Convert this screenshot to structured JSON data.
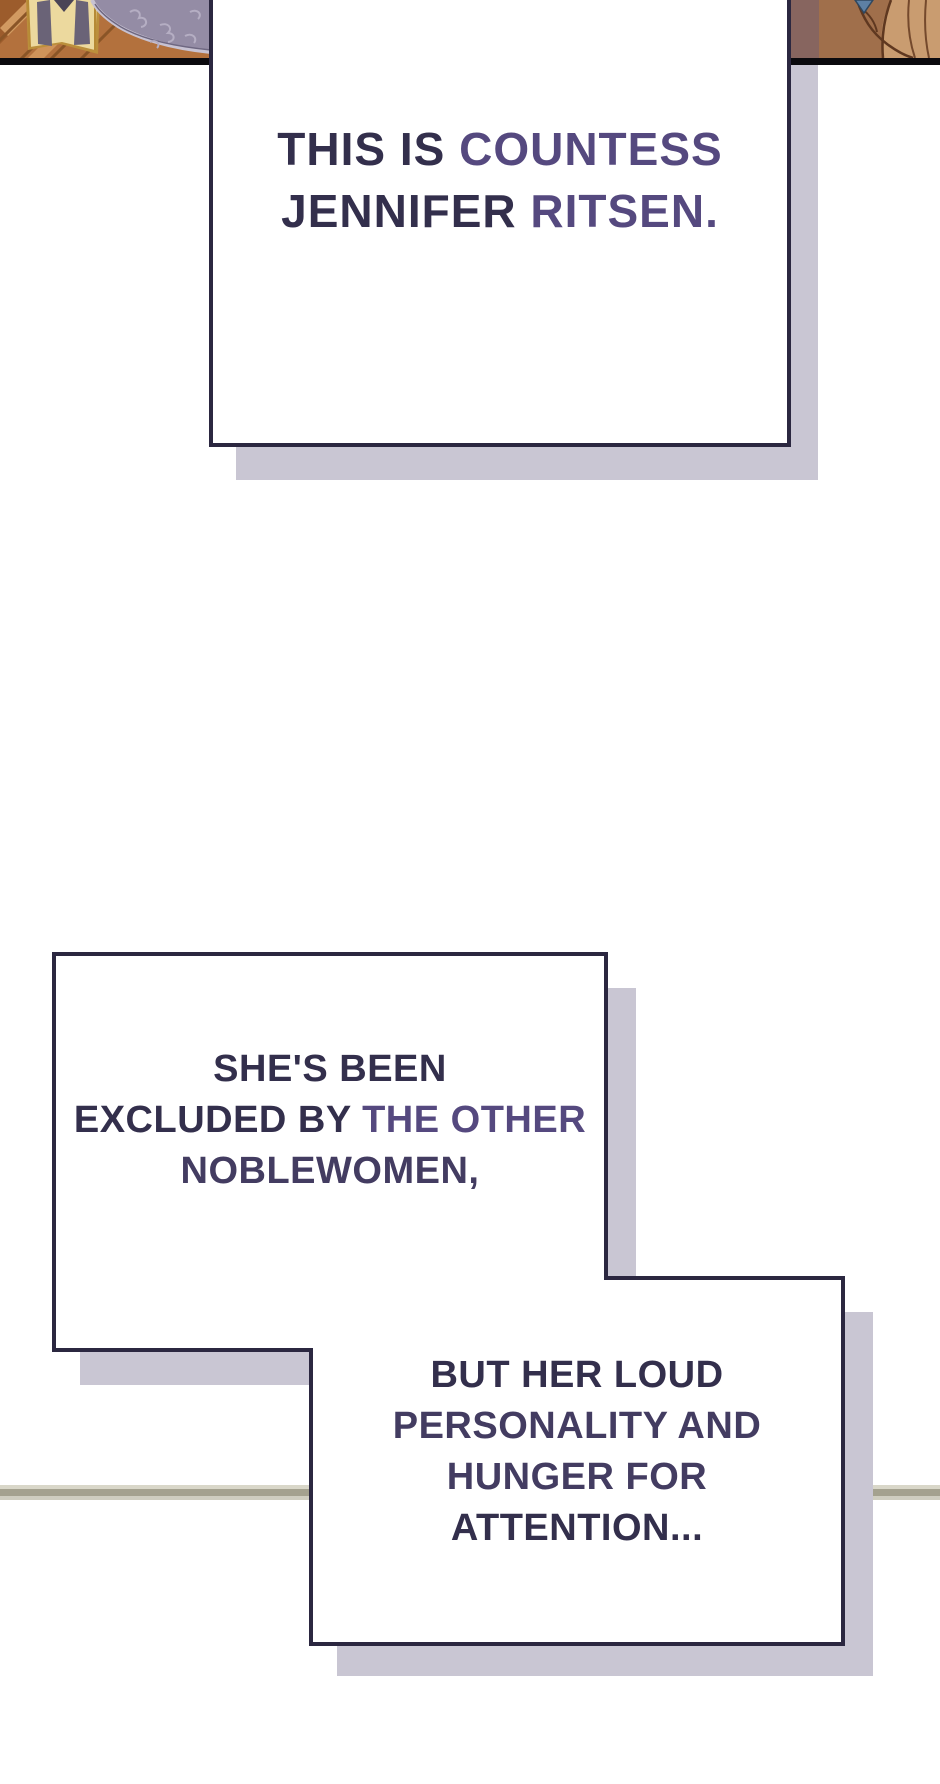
{
  "page": {
    "width": 940,
    "height": 1784,
    "background": "#ffffff"
  },
  "colors": {
    "text_dark": "#332f4c",
    "text_purple": "#55497f",
    "text_mid": "#433c61",
    "box_border": "#2b2740",
    "box_fill": "#ffffff",
    "box_shadow": "#c9c6d3",
    "panel_border": "#0b0a0e",
    "floor_line": "#a4a18f",
    "wood": "#b3713d",
    "banner_cream": "#ecd99e",
    "banner_stripe": "#6a6377",
    "damask": "#948ca5",
    "skin_brown": "#a06f4b",
    "hair_tan": "#c99c70",
    "blue_patch": "#5d80a4"
  },
  "top_panel": {
    "left_art_label": "parquet floor with folded banner and damask curtain",
    "right_art_label": "cropped figure with auburn tones"
  },
  "narration_boxes": [
    {
      "id": "countess-intro",
      "lines": [
        [
          {
            "text": "THIS IS ",
            "tone": "text_dark"
          },
          {
            "text": "COUNTESS",
            "tone": "text_purple"
          }
        ],
        [
          {
            "text": "JENNIFER ",
            "tone": "text_dark"
          },
          {
            "text": "RITSEN.",
            "tone": "text_purple"
          }
        ]
      ]
    },
    {
      "id": "excluded",
      "lines": [
        [
          {
            "text": "SHE'S BEEN",
            "tone": "text_dark"
          }
        ],
        [
          {
            "text": "EXCLUDED BY ",
            "tone": "text_dark"
          },
          {
            "text": "THE OTHER",
            "tone": "text_purple"
          }
        ],
        [
          {
            "text": "NOBLEWOMEN,",
            "tone": "text_mid"
          }
        ]
      ]
    },
    {
      "id": "personality",
      "lines": [
        [
          {
            "text": "BUT HER LOUD",
            "tone": "text_dark"
          }
        ],
        [
          {
            "text": "PERSONALITY AND",
            "tone": "text_mid"
          }
        ],
        [
          {
            "text": "HUNGER FOR",
            "tone": "text_mid"
          }
        ],
        [
          {
            "text": "ATTENTION...",
            "tone": "text_dark"
          }
        ]
      ]
    }
  ]
}
